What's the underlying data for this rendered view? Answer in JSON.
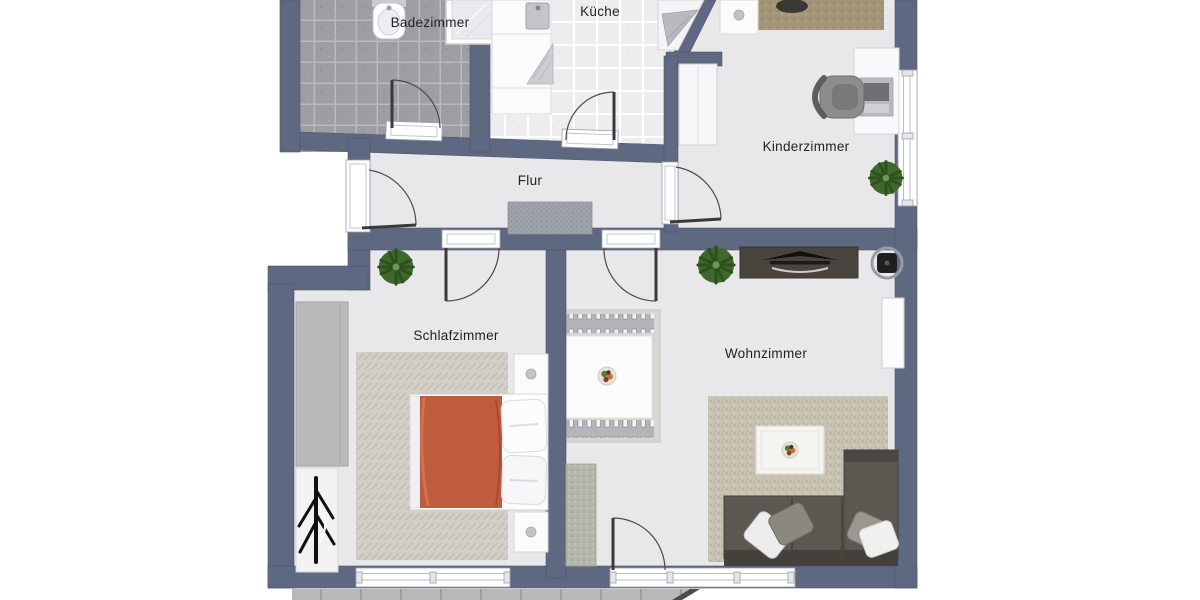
{
  "plan": {
    "type": "apartment-floorplan",
    "rooms": [
      {
        "id": "badezimmer",
        "label": "Badezimmer"
      },
      {
        "id": "kueche",
        "label": "Küche"
      },
      {
        "id": "kinderzimmer",
        "label": "Kinderzimmer"
      },
      {
        "id": "flur",
        "label": "Flur"
      },
      {
        "id": "schlafzimmer",
        "label": "Schlafzimmer"
      },
      {
        "id": "wohnzimmer",
        "label": "Wohnzimmer"
      }
    ],
    "colors": {
      "wall": "#5e6880",
      "floor": "#e8e8ea",
      "bath_tile": "#9d9da3",
      "kitchen_tile": "#ededf0",
      "bed_duvet": "#c05c3d",
      "sofa": "#5b5852",
      "tv_board": "#4a443f",
      "living_rug": "#c7c2b1",
      "kids_rug": "#a49678",
      "terrace": "#b9b9b7"
    }
  }
}
